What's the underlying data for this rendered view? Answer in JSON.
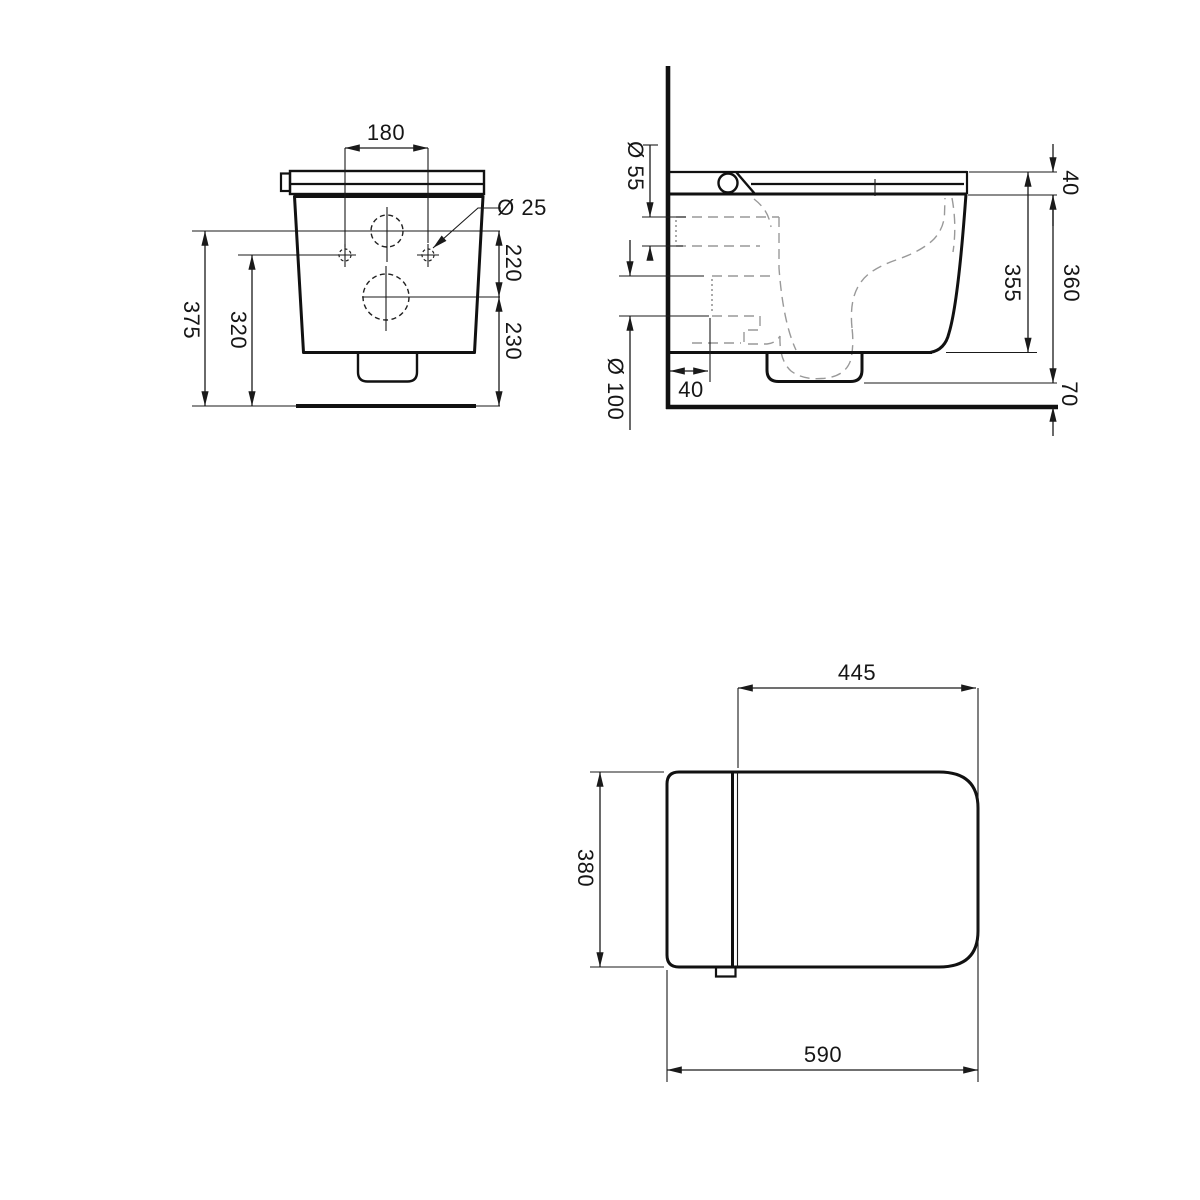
{
  "drawing": {
    "kind": "technical-dimension-drawing",
    "views": [
      "front",
      "side",
      "top"
    ]
  },
  "colors": {
    "line": "#1a1a1a",
    "detail_dashed": "#999999",
    "background": "#ffffff"
  },
  "front_view": {
    "hole_spacing": "180",
    "hole_diameter": "Ø 25",
    "inlet_center_height": "375",
    "fixing_hole_height": "320",
    "inlet_to_outlet": "220",
    "outlet_center_height": "230"
  },
  "side_view": {
    "seat_inlet_diameter": "Ø 55",
    "outlet_diameter": "Ø 100",
    "seat_thickness": "40",
    "body_height": "360",
    "inner_depth": "355",
    "outlet_wall_offset": "40",
    "floor_clearance": "70"
  },
  "top_view": {
    "seat_depth": "445",
    "bowl_width": "380",
    "total_depth": "590"
  }
}
